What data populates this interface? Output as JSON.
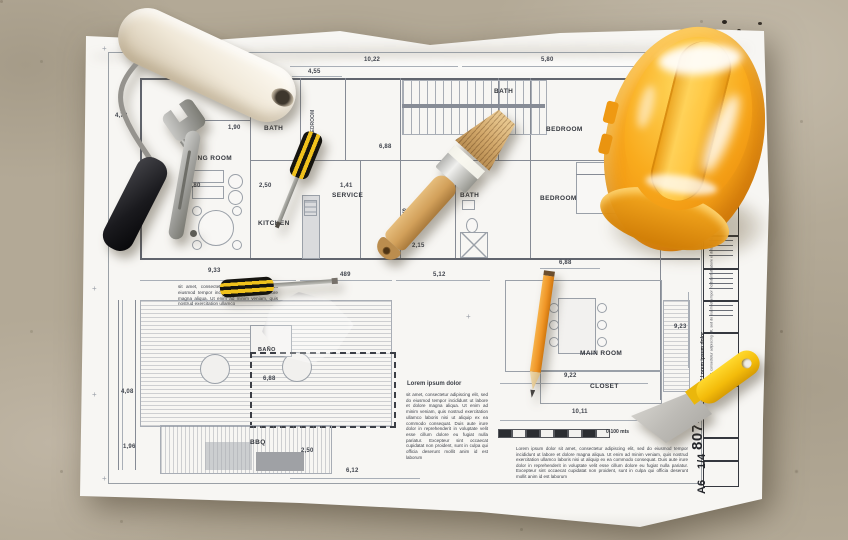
{
  "scene": {
    "objects": [
      {
        "name": "blueprint-floor-plan",
        "color": "#f7f6f3"
      },
      {
        "name": "paint-roller",
        "color": "#f2ecdf"
      },
      {
        "name": "adjustable-wrench",
        "color": "#a9a9a6"
      },
      {
        "name": "small-screwdriver",
        "color": "#f2c01d"
      },
      {
        "name": "flat-screwdriver",
        "color": "#f2c01d"
      },
      {
        "name": "paint-brush",
        "color": "#d3a465"
      },
      {
        "name": "safety-hard-hat",
        "color": "#f8a71b"
      },
      {
        "name": "pencil",
        "color": "#ef9c2e"
      },
      {
        "name": "putty-knife",
        "color": "#f7c713"
      },
      {
        "name": "concrete-floor",
        "color": "#b3a996"
      }
    ]
  },
  "blueprint": {
    "rooms": [
      "LIVING ROOM",
      "BATH",
      "KITCHEN",
      "BEDROOM",
      "BATH",
      "SERVICE",
      "STUDIO",
      "BATH",
      "BEDROOM",
      "BEDROOM",
      "BAÑO",
      "MAIN ROOM",
      "CLOSET",
      "BBQ"
    ],
    "dimensions": [
      "4,55",
      "10,22",
      "5,80",
      "4,73",
      "1,90",
      "6,88",
      "2,50",
      "4,80",
      "1,41",
      "2,15",
      "9,33",
      "489",
      "5,12",
      "6,88",
      "2,15",
      "3,40",
      "9,23",
      "4,08",
      "6,88",
      "9,22",
      "10,11",
      "1,96",
      "2,50",
      "6,12"
    ],
    "notes": {
      "top_fragment": "sit amet, consectetur adipiscing elit, sed do eiusmod tempor incididunt ut labore et dolore magna aliqua. Ut enim ad minim veniam, quis nostrud exercitation ullamco",
      "left_heading": "Lorem ipsum dolor",
      "left_body": "sit amet, consectetur adipiscing elit, sed do eiusmod tempor incididunt ut labore et dolore magna aliqua. Ut enim ad minim veniam, quis nostrud exercitation ullamco laboris nisi ut aliquip ex ea commodo consequat. Duis aute irure dolor in reprehenderit in voluptate velit esse cillum dolore eu fugiat nulla pariatur. Excepteur sint occaecat cupidatat non proident, sunt in culpa qui officia deserunt mollit anim id est laborum",
      "bottom_body": "Lorem ipsum dolor sit amet, consectetur adipiscing elit, sed do eiusmod tempor incididunt ut labore et dolore magna aliqua. Ut enim ad minim veniam, quis nostrud exercitation ullamco laboris nisi ut aliquip ex ea commodo consequat. Duis aute irure dolor in reprehenderit in voluptate velit esse cillum dolore eu fugiat nulla pariatur. Excepteur sint occaecat cupidatat non proident, sunt in culpa qui officia deserunt mollit anim id est laborum"
    },
    "scale_bar": {
      "label": "0-100 mts"
    },
    "title_block": {
      "project_label": "Lorem ipsu",
      "doc_number_title": "807 Lorem ipsum dolor",
      "doc_note": "sit amet, consectetur adipiscing elit, sed do eiusmod tempor incididunt ut labore et dolore magna aliqua. Ut enim ad minim veniam, quis nostrud",
      "sheet_code": "807-A",
      "scale": "1/4",
      "size": "A6"
    }
  }
}
